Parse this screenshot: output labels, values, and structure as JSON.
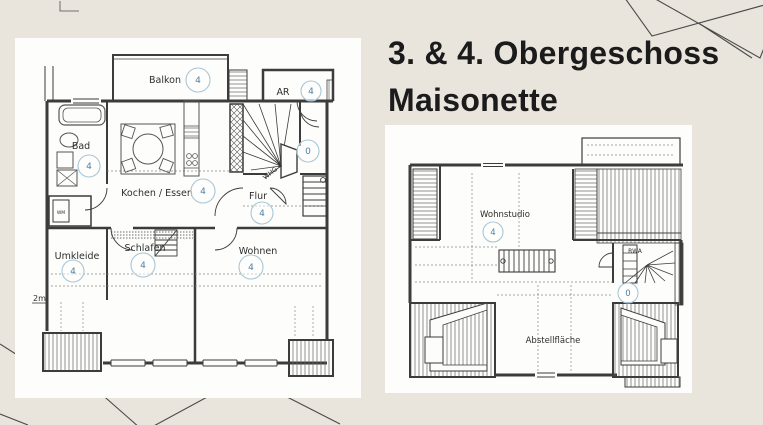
{
  "colors": {
    "background": "#e9e5dd",
    "panel": "#fdfdfb",
    "plan_line": "#3c3c3c",
    "badge_ring": "#a9c6d5",
    "badge_number": "#4d80a6",
    "title_text": "#1b1b1b"
  },
  "title": {
    "line1": "3. & 4. Obergeschoss",
    "line2": "Maisonette"
  },
  "lower_plan": {
    "rooms": [
      {
        "name": "Balkon",
        "unit": "4"
      },
      {
        "name": "AR",
        "unit": "4"
      },
      {
        "name": "Bad",
        "unit": "4"
      },
      {
        "name": "Kochen / Essen",
        "unit": "4"
      },
      {
        "name": "Flur",
        "unit": "4"
      },
      {
        "name": "Umkleide",
        "unit": "4"
      },
      {
        "name": "Schlafen",
        "unit": "4"
      },
      {
        "name": "Wohnen",
        "unit": "4"
      }
    ],
    "stair_unit": "0",
    "entry_label": "WHG 4",
    "height_marker": "2m",
    "washer_label": "WM"
  },
  "upper_plan": {
    "rooms": [
      {
        "name": "Wohnstudio",
        "unit": "4"
      },
      {
        "name": "Abstellfläche"
      }
    ],
    "stair_unit": "0",
    "vent_label": "RWA"
  }
}
